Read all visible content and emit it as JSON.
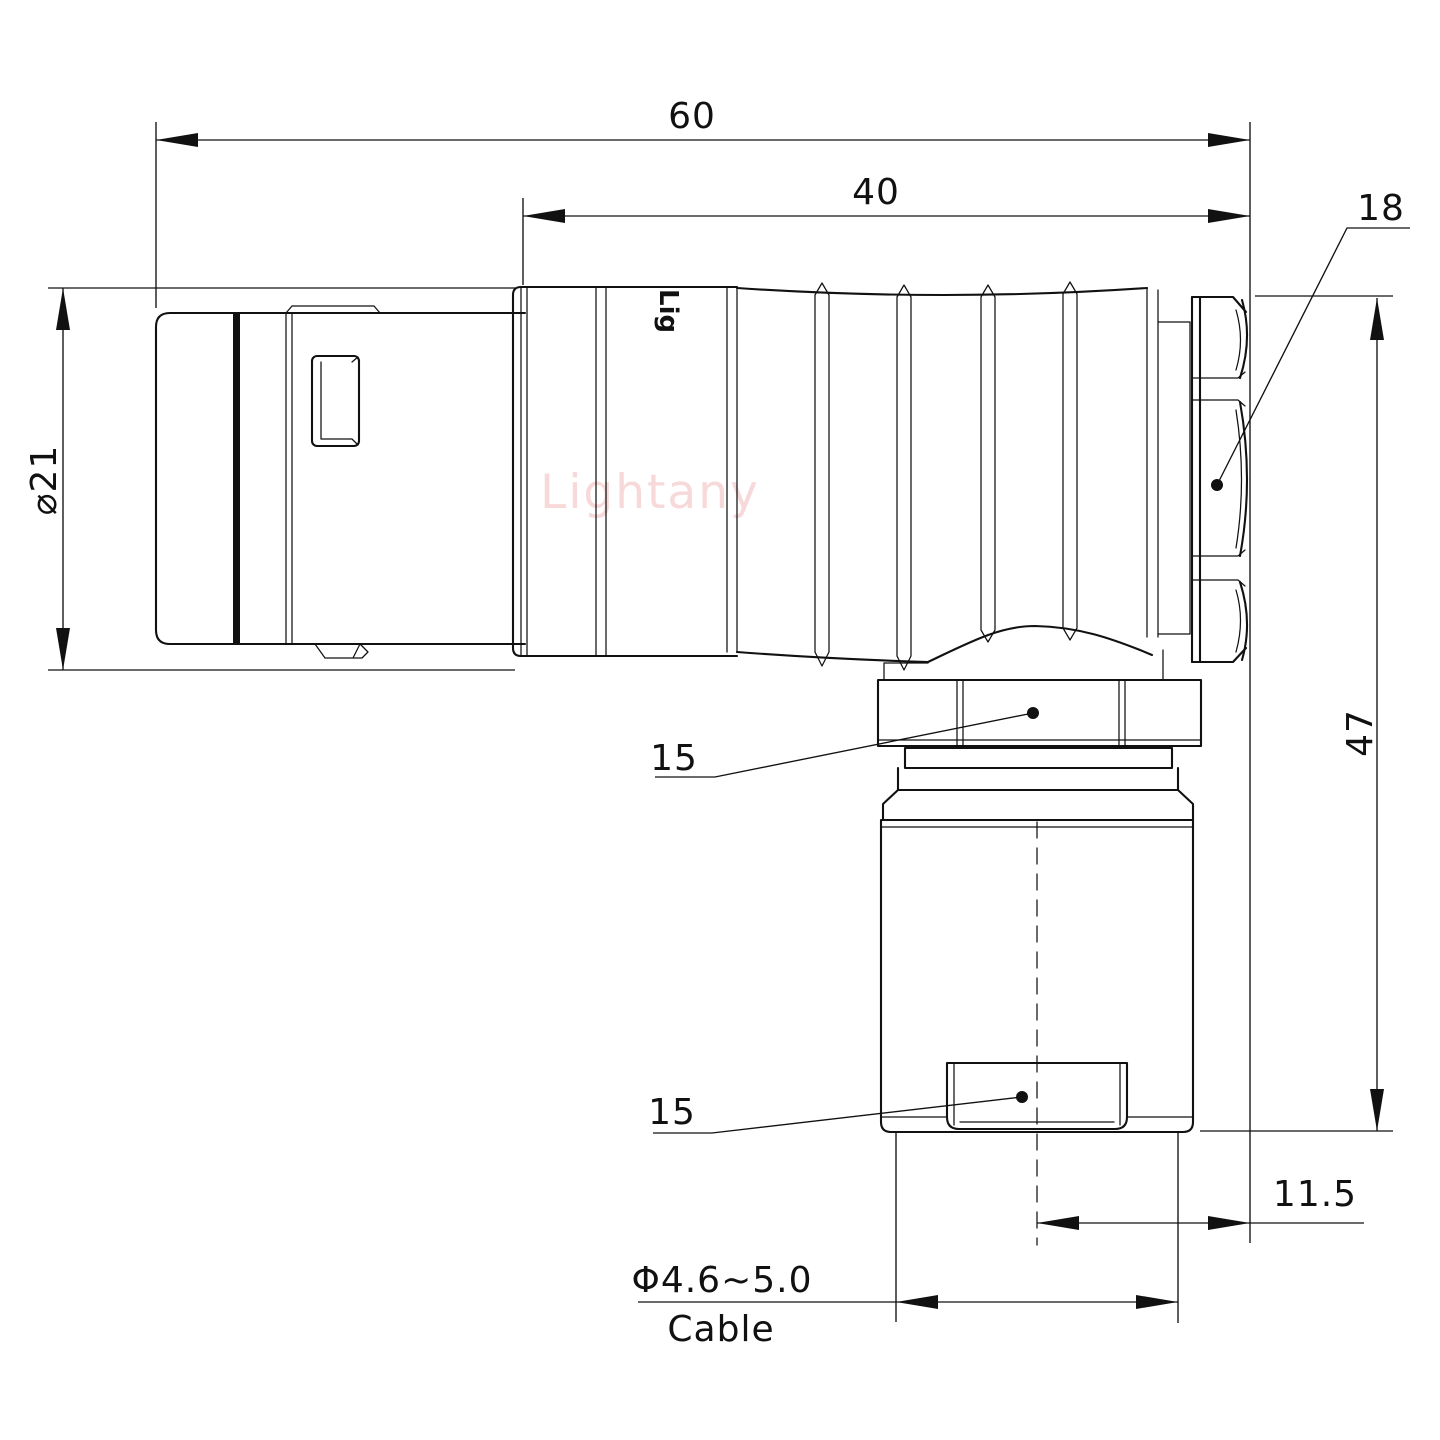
{
  "drawing": {
    "watermark": "Lightany",
    "logo_text": "Lig",
    "dims": {
      "overall_length": "60",
      "body_length": "40",
      "nut_size": "18",
      "shell_diameter": "⌀21",
      "height": "47",
      "coupling_nut": "15",
      "cable_bushing": "15",
      "cable_offset": "11.5",
      "cable_diameter": "Φ4.6~5.0",
      "cable_label": "Cable"
    },
    "colors": {
      "line": "#111111",
      "watermark": "#f3c0c0",
      "background": "#ffffff"
    }
  }
}
